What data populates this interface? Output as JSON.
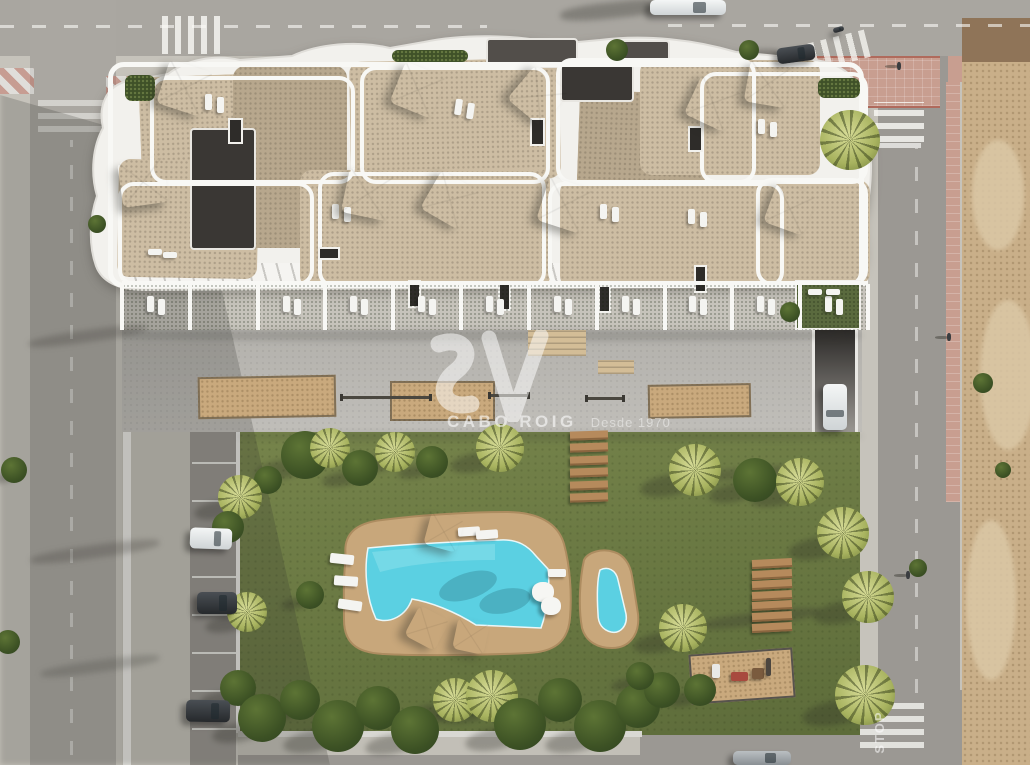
{
  "watermark": {
    "logo_mark": "SV",
    "brand": "CABO ROIG",
    "tagline": "Desde 1970"
  },
  "road_markings": {
    "stop_text": "STOP"
  },
  "palette": {
    "base": "#c6c3bb",
    "roadTop": "#a9a6a0",
    "roadLeft": "#aaa7a1",
    "roadRight": "#9b9893",
    "parking": "#96938d",
    "apron": "#c2bfb7",
    "curb": "#e9e8e4",
    "building": "#f2f1ed",
    "parapet": "#f8f8f5",
    "gravel": "#cdbda3",
    "gravelDark": "#b7a78d",
    "roofDark": "#3a3734",
    "roofMid": "#524e4a",
    "terraceGrass": "#55643a",
    "plazaA": "#b3b1ac",
    "plazaB": "#c0beb9",
    "sand": "#c9a97d",
    "stair": "#d3bd97",
    "lawnA": "#76844b",
    "lawnB": "#5d6c3a",
    "deck": "#c8a77b",
    "deckEdge": "#ad8c60",
    "water": "#5bd0e2",
    "waterLight": "#8fe2ec",
    "wood": "#b68a5c",
    "woodDark": "#8a653f",
    "dirtA": "#c9af89",
    "dirtB": "#dbc8a6",
    "dirtShade": "#8f7458",
    "pink": "#c89e90",
    "pinkLine": "#b06a5c",
    "hedge": "#3f5128",
    "treeDark": "#3c5124",
    "treeLite": "#c9cf87",
    "white": "#ffffff",
    "carDark": "#3c4044",
    "carWhite": "#eff1f1",
    "carGray": "#aab0b2",
    "wallLight": "#e9e8e4",
    "grassRoof": "#5a6a3e"
  },
  "crosswalks": [
    {
      "x": 162,
      "y": 16,
      "w": 62,
      "h": 38,
      "o": "v",
      "r": 0,
      "a": 0.8
    },
    {
      "x": 810,
      "y": 36,
      "w": 60,
      "h": 28,
      "o": "v",
      "r": -14,
      "a": 0.75
    },
    {
      "x": 874,
      "y": 102,
      "w": 50,
      "h": 40,
      "o": "h",
      "r": 0,
      "a": 0.8
    },
    {
      "x": 38,
      "y": 96,
      "w": 76,
      "h": 36,
      "o": "h",
      "r": 0,
      "a": 0.5
    },
    {
      "x": 860,
      "y": 700,
      "w": 64,
      "h": 48,
      "o": "h",
      "r": 0,
      "a": 0.75
    }
  ],
  "lane_lines": [
    {
      "x": 0,
      "y": 25,
      "w": 487,
      "h": 3,
      "o": "h",
      "a": 0.6
    },
    {
      "x": 668,
      "y": 24,
      "w": 362,
      "h": 3,
      "o": "h",
      "a": 0.6
    },
    {
      "x": 70,
      "y": 140,
      "w": 3,
      "h": 615,
      "o": "v",
      "a": 0.45
    },
    {
      "x": 915,
      "y": 148,
      "w": 3,
      "h": 545,
      "o": "v",
      "a": 0.45
    },
    {
      "x": 879,
      "y": 143,
      "w": 42,
      "h": 5,
      "o": "s",
      "a": 0.7
    }
  ],
  "parking_rows": {
    "x": 192,
    "w": 44,
    "y0": 462,
    "count": 8,
    "gap": 38
  },
  "striped_curbs": [
    [
      0,
      68,
      34,
      26
    ],
    [
      106,
      76,
      26,
      20
    ]
  ],
  "sandpits": [
    {
      "x": 198,
      "y": 376,
      "w": 134,
      "h": 38,
      "r": -1
    },
    {
      "x": 390,
      "y": 381,
      "w": 101,
      "h": 36,
      "r": 0
    },
    {
      "x": 648,
      "y": 384,
      "w": 99,
      "h": 30,
      "r": -1
    }
  ],
  "stairs": [
    {
      "x": 528,
      "y": 330,
      "w": 58,
      "h": 26
    },
    {
      "x": 598,
      "y": 360,
      "w": 36,
      "h": 14
    }
  ],
  "fitness_rails": [
    {
      "x": 340,
      "y": 396,
      "w": 92
    },
    {
      "x": 488,
      "y": 394,
      "w": 42
    },
    {
      "x": 585,
      "y": 397,
      "w": 40
    }
  ],
  "skylights": [
    [
      408,
      280,
      9,
      24
    ],
    [
      498,
      283,
      9,
      24
    ],
    [
      598,
      285,
      9,
      24
    ],
    [
      694,
      265,
      9,
      24
    ],
    [
      318,
      247,
      18,
      9
    ],
    [
      530,
      118,
      11,
      24
    ],
    [
      688,
      126,
      11,
      22
    ],
    [
      228,
      118,
      11,
      22
    ]
  ],
  "roof_gravel": [
    [
      140,
      74,
      200,
      100,
      -2,
      0
    ],
    [
      118,
      160,
      140,
      118,
      1,
      0
    ],
    [
      233,
      66,
      114,
      182,
      0,
      1
    ],
    [
      350,
      60,
      210,
      120,
      -1,
      0
    ],
    [
      300,
      170,
      250,
      118,
      0,
      0
    ],
    [
      577,
      92,
      128,
      170,
      2,
      1
    ],
    [
      560,
      180,
      240,
      108,
      0,
      0
    ],
    [
      640,
      60,
      180,
      115,
      0,
      0
    ],
    [
      700,
      180,
      170,
      105,
      0,
      0
    ]
  ],
  "roof_dark": [
    [
      190,
      128,
      62,
      118,
      "roofDark"
    ],
    [
      486,
      38,
      88,
      26,
      "roofMid"
    ],
    [
      560,
      64,
      70,
      34,
      "roofDark"
    ],
    [
      616,
      40,
      50,
      22,
      "roofMid"
    ]
  ],
  "parapets": [
    [
      108,
      62,
      756,
      226
    ],
    [
      150,
      76,
      205,
      108
    ],
    [
      360,
      66,
      190,
      118
    ],
    [
      556,
      58,
      200,
      126
    ],
    [
      700,
      72,
      168,
      112
    ],
    [
      118,
      182,
      196,
      104
    ],
    [
      318,
      172,
      228,
      116
    ],
    [
      548,
      182,
      236,
      106
    ],
    [
      756,
      178,
      112,
      108
    ]
  ],
  "hedges": [
    [
      392,
      50,
      76,
      12
    ],
    [
      818,
      78,
      42,
      20
    ],
    [
      125,
      75,
      30,
      26
    ]
  ],
  "green_roof": {
    "x": 795,
    "y": 280,
    "w": 62,
    "h": 46
  },
  "terrace_row": {
    "x0": 122,
    "x1": 868,
    "y": 284,
    "h": 46,
    "count": 11,
    "no_loungers": [
      1
    ]
  },
  "parasols": [
    [
      185,
      88,
      46,
      18
    ],
    [
      143,
      182,
      46,
      -8
    ],
    [
      418,
      90,
      44,
      22
    ],
    [
      538,
      96,
      44,
      40
    ],
    [
      368,
      194,
      46,
      12
    ],
    [
      450,
      200,
      44,
      30
    ],
    [
      565,
      205,
      46,
      18
    ],
    [
      713,
      103,
      44,
      25
    ],
    [
      768,
      84,
      42,
      10
    ],
    [
      790,
      209,
      42,
      20
    ],
    [
      444,
      532,
      34,
      15
    ],
    [
      427,
      628,
      34,
      28
    ],
    [
      471,
      636,
      32,
      12
    ]
  ],
  "loungers": [
    [
      205,
      94,
      7,
      16,
      0
    ],
    [
      217,
      97,
      7,
      16,
      0
    ],
    [
      455,
      99,
      7,
      16,
      8
    ],
    [
      467,
      103,
      7,
      16,
      8
    ],
    [
      332,
      204,
      7,
      15,
      0
    ],
    [
      344,
      207,
      7,
      15,
      0
    ],
    [
      600,
      204,
      7,
      15,
      0
    ],
    [
      612,
      207,
      7,
      15,
      0
    ],
    [
      688,
      209,
      7,
      15,
      0
    ],
    [
      700,
      212,
      7,
      15,
      0
    ],
    [
      758,
      119,
      7,
      15,
      0
    ],
    [
      770,
      122,
      7,
      15,
      0
    ],
    [
      148,
      249,
      14,
      6,
      0
    ],
    [
      163,
      252,
      14,
      6,
      0
    ],
    [
      808,
      289,
      14,
      6,
      0
    ],
    [
      826,
      289,
      14,
      6,
      0
    ],
    [
      330,
      554,
      24,
      10,
      6
    ],
    [
      334,
      576,
      24,
      10,
      4
    ],
    [
      338,
      600,
      24,
      10,
      8
    ],
    [
      458,
      527,
      22,
      9,
      -4
    ],
    [
      476,
      530,
      22,
      9,
      -4
    ],
    [
      548,
      569,
      18,
      8,
      0
    ]
  ],
  "beanbags": [
    [
      543,
      593,
      11
    ],
    [
      551,
      607,
      10
    ]
  ],
  "bench_groups": [
    {
      "x": 570,
      "y0": 431,
      "w": 38,
      "h": 7,
      "count": 6,
      "dy": 12.4,
      "r": -2
    },
    {
      "x": 752,
      "y0": 559,
      "w": 40,
      "h": 7,
      "count": 7,
      "dy": 10.6,
      "r": -3
    }
  ],
  "playground": {
    "x": 690,
    "y": 651,
    "w": 100,
    "h": 46,
    "r": -4,
    "items": [
      [
        712,
        664,
        8,
        14,
        "#e8e8e6"
      ],
      [
        731,
        672,
        17,
        9,
        "#a84a3e"
      ],
      [
        752,
        668,
        12,
        11,
        "#7a5b3e"
      ],
      [
        766,
        658,
        5,
        18,
        "#4c463f"
      ]
    ]
  },
  "trees": [
    [
      850,
      140,
      30,
      "p"
    ],
    [
      617,
      50,
      11,
      "b"
    ],
    [
      749,
      50,
      10,
      "b"
    ],
    [
      97,
      224,
      9,
      "b"
    ],
    [
      983,
      383,
      10,
      "b"
    ],
    [
      918,
      568,
      9,
      "b"
    ],
    [
      1003,
      470,
      8,
      "b"
    ],
    [
      865,
      695,
      30,
      "p"
    ],
    [
      795,
      490,
      12,
      "b"
    ],
    [
      790,
      312,
      10,
      "b"
    ],
    [
      695,
      470,
      26,
      "p"
    ],
    [
      755,
      480,
      22,
      "b"
    ],
    [
      800,
      482,
      24,
      "p"
    ],
    [
      843,
      533,
      26,
      "p"
    ],
    [
      868,
      597,
      26,
      "p"
    ],
    [
      683,
      628,
      24,
      "p"
    ],
    [
      305,
      455,
      24,
      "b"
    ],
    [
      330,
      448,
      20,
      "p"
    ],
    [
      360,
      468,
      18,
      "b"
    ],
    [
      395,
      452,
      20,
      "p"
    ],
    [
      432,
      462,
      16,
      "b"
    ],
    [
      500,
      448,
      24,
      "p"
    ],
    [
      268,
      480,
      14,
      "b"
    ],
    [
      240,
      497,
      22,
      "p"
    ],
    [
      228,
      527,
      16,
      "b"
    ],
    [
      247,
      612,
      20,
      "p"
    ],
    [
      238,
      688,
      18,
      "b"
    ],
    [
      310,
      595,
      14,
      "b"
    ],
    [
      262,
      718,
      24,
      "b"
    ],
    [
      300,
      700,
      20,
      "b"
    ],
    [
      338,
      726,
      26,
      "b"
    ],
    [
      378,
      708,
      22,
      "b"
    ],
    [
      415,
      730,
      24,
      "b"
    ],
    [
      455,
      700,
      22,
      "p"
    ],
    [
      492,
      696,
      26,
      "p"
    ],
    [
      520,
      724,
      26,
      "b"
    ],
    [
      560,
      700,
      22,
      "b"
    ],
    [
      600,
      726,
      26,
      "b"
    ],
    [
      638,
      706,
      22,
      "b"
    ],
    [
      662,
      690,
      18,
      "b"
    ],
    [
      14,
      470,
      13,
      "b"
    ],
    [
      8,
      642,
      12,
      "b"
    ],
    [
      700,
      690,
      16,
      "b"
    ],
    [
      640,
      676,
      14,
      "b"
    ]
  ],
  "cars": [
    [
      650,
      0,
      76,
      15,
      0,
      "white"
    ],
    [
      777,
      46,
      38,
      16,
      -8,
      "dark"
    ],
    [
      833,
      27,
      11,
      5,
      -15,
      "dark"
    ],
    [
      190,
      528,
      42,
      21,
      2,
      "white"
    ],
    [
      197,
      592,
      40,
      22,
      0,
      "dark"
    ],
    [
      186,
      700,
      44,
      22,
      1,
      "dark"
    ],
    [
      823,
      384,
      24,
      46,
      0,
      "white"
    ],
    [
      733,
      751,
      58,
      14,
      0,
      "gray"
    ]
  ],
  "people": [
    [
      897,
      62
    ],
    [
      947,
      333
    ],
    [
      906,
      571
    ]
  ],
  "shadow_shapes": [
    {
      "t": "poly",
      "pts": "0px 95px,190px 150px,330px 765px,0px 765px",
      "a": 0.22
    },
    {
      "t": "rect",
      "x": 770,
      "y": 150,
      "w": 96,
      "h": 13,
      "r": -7,
      "a": 0.3
    },
    {
      "t": "rect",
      "x": 690,
      "y": 468,
      "w": 108,
      "h": 11,
      "r": -5,
      "a": 0.28
    },
    {
      "t": "rect",
      "x": 700,
      "y": 612,
      "w": 120,
      "h": 13,
      "r": -7,
      "a": 0.3
    },
    {
      "t": "rect",
      "x": 560,
      "y": 2,
      "w": 110,
      "h": 16,
      "r": -6,
      "a": 0.33
    },
    {
      "t": "rect",
      "x": 732,
      "y": 50,
      "w": 48,
      "h": 12,
      "r": -6,
      "a": 0.3
    },
    {
      "t": "rect",
      "x": 122,
      "y": 330,
      "w": 740,
      "h": 11,
      "r": 0,
      "a": 0.18
    },
    {
      "t": "rect",
      "x": 238,
      "y": 432,
      "w": 624,
      "h": 9,
      "r": 0,
      "a": 0.15
    },
    {
      "t": "rect",
      "x": 28,
      "y": 330,
      "w": 120,
      "h": 12,
      "r": -8,
      "a": 0.25
    },
    {
      "t": "rect",
      "x": 30,
      "y": 545,
      "w": 130,
      "h": 13,
      "r": -8,
      "a": 0.25
    },
    {
      "t": "rect",
      "x": 40,
      "y": 660,
      "w": 120,
      "h": 12,
      "r": -8,
      "a": 0.22
    }
  ]
}
